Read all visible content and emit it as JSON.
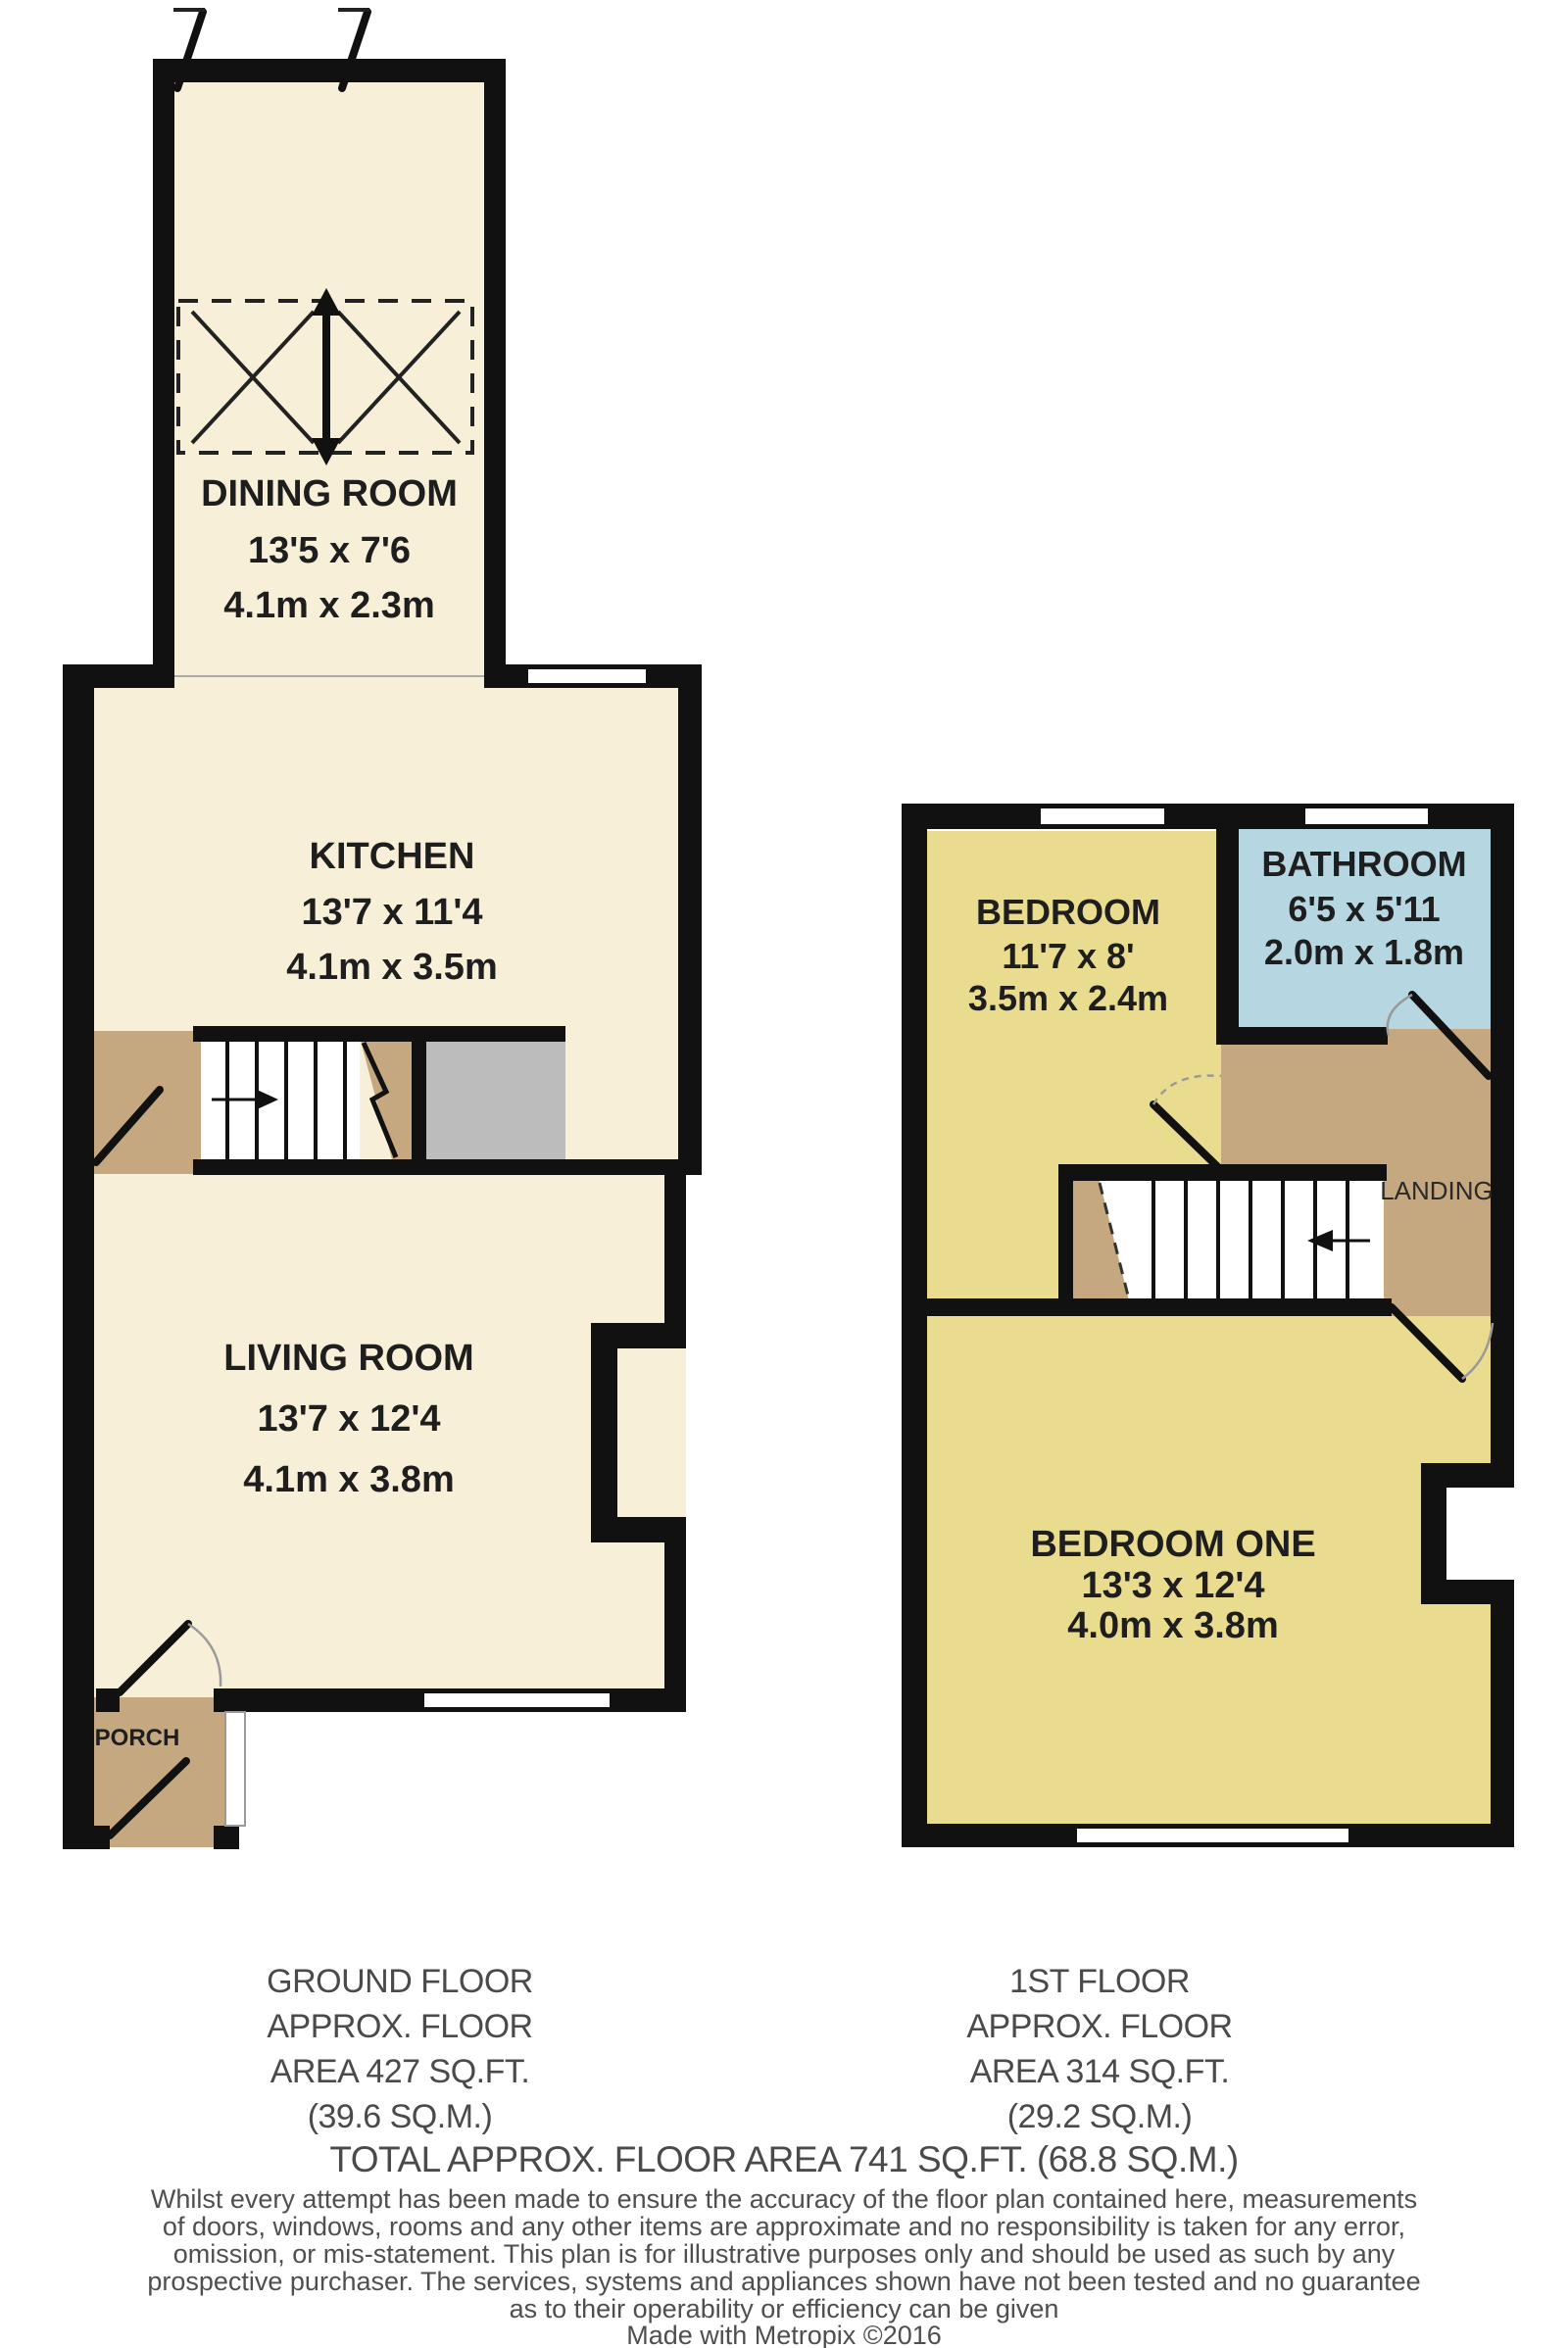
{
  "ground_floor": {
    "dining_room": {
      "label": "DINING ROOM",
      "imperial": "13'5 x 7'6",
      "metric": "4.1m x 2.3m"
    },
    "kitchen": {
      "label": "KITCHEN",
      "imperial": "13'7 x 11'4",
      "metric": "4.1m x 3.5m"
    },
    "living_room": {
      "label": "LIVING ROOM",
      "imperial": "13'7 x 12'4",
      "metric": "4.1m x 3.8m"
    },
    "porch": {
      "label": "PORCH"
    },
    "area_caption": {
      "line1": "GROUND FLOOR",
      "line2": "APPROX. FLOOR",
      "line3": "AREA 427 SQ.FT.",
      "line4": "(39.6 SQ.M.)"
    }
  },
  "first_floor": {
    "bedroom": {
      "label": "BEDROOM",
      "imperial": "11'7 x 8'",
      "metric": "3.5m x 2.4m"
    },
    "bathroom": {
      "label": "BATHROOM",
      "imperial": "6'5 x 5'11",
      "metric": "2.0m x 1.8m"
    },
    "landing": {
      "label": "LANDING"
    },
    "bedroom_one": {
      "label": "BEDROOM ONE",
      "imperial": "13'3 x 12'4",
      "metric": "4.0m x 3.8m"
    },
    "area_caption": {
      "line1": "1ST FLOOR",
      "line2": "APPROX. FLOOR",
      "line3": "AREA 314 SQ.FT.",
      "line4": "(29.2 SQ.M.)"
    }
  },
  "total_area_caption": "TOTAL APPROX. FLOOR AREA 741 SQ.FT. (68.8 SQ.M.)",
  "disclaimer": {
    "line1": "Whilst every attempt has been made to ensure the accuracy of the floor plan contained here, measurements",
    "line2": "of doors, windows, rooms and any other items are approximate and no responsibility is taken for any error,",
    "line3": "omission, or mis-statement. This plan is for illustrative purposes only and should be used as such by any",
    "line4": "prospective purchaser. The services, systems and appliances shown have not been tested and no guarantee",
    "line5": "as to their operability or efficiency can be given",
    "credit": "Made with Metropix ©2016"
  },
  "colors": {
    "wall": "#111111",
    "floor_cream": "#f7efd8",
    "floor_yellow": "#e9dc8e",
    "floor_blue": "#b6d7e1",
    "floor_tan": "#c5a87f",
    "storage_gray": "#bcbcbc",
    "label_text": "#1e1e1e",
    "caption_text": "#4a4a4a"
  }
}
